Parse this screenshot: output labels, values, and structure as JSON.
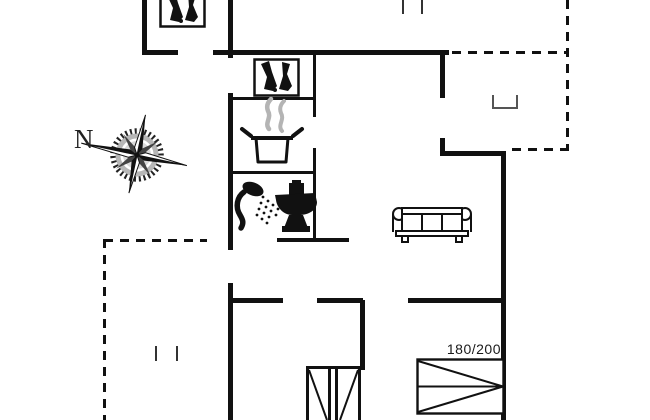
{
  "canvas": {
    "width": 650,
    "height": 420,
    "background": "#ffffff"
  },
  "labels": {
    "compass_north": "N",
    "double_bed_size": "180/200"
  },
  "palette": {
    "wall": "#111111",
    "thin_line": "#333333",
    "steam": "#b4b4b4",
    "text": "#1a1a1a"
  },
  "icons": [
    {
      "name": "compass-rose-icon"
    },
    {
      "name": "boots-icon-top"
    },
    {
      "name": "boots-icon-hall"
    },
    {
      "name": "cooking-pot-icon"
    },
    {
      "name": "steam-icon"
    },
    {
      "name": "shower-icon"
    },
    {
      "name": "toilet-icon"
    },
    {
      "name": "sofa-icon"
    },
    {
      "name": "double-bed-icon"
    },
    {
      "name": "bunk-bed-icon"
    },
    {
      "name": "step-icon"
    }
  ]
}
